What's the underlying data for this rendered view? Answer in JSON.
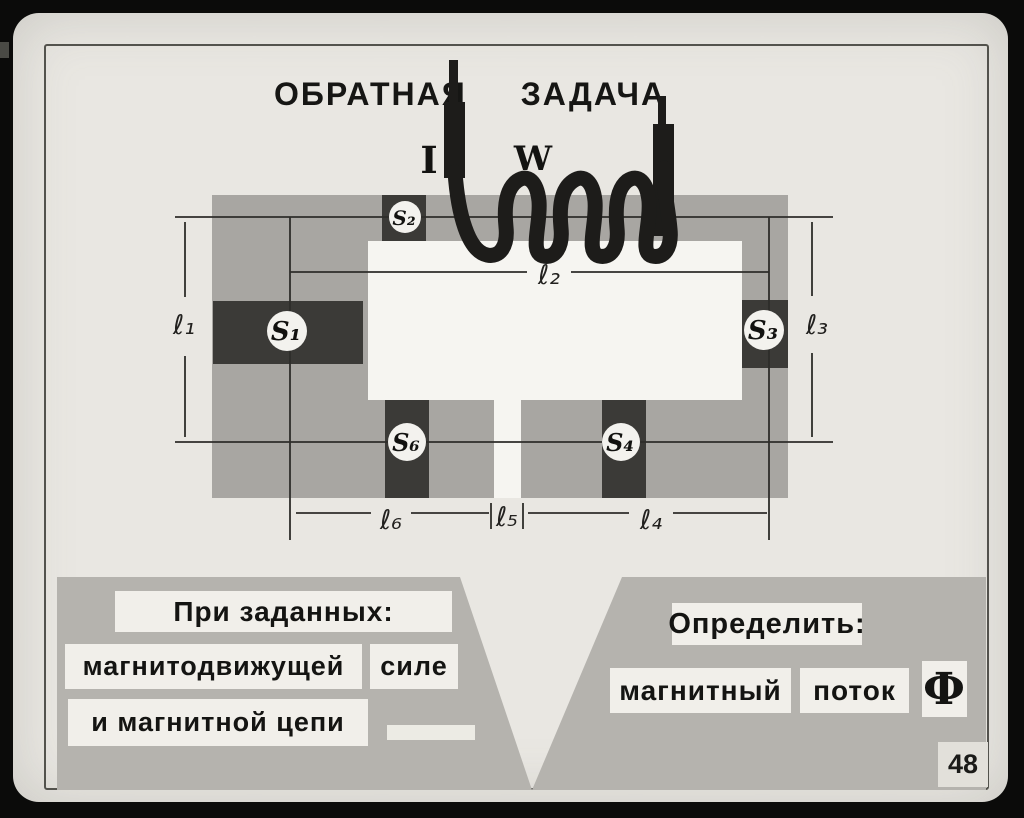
{
  "slide": {
    "title_word1": "ОБРАТНАЯ",
    "title_word2": "ЗАДАЧА",
    "page_number": "48"
  },
  "diagram": {
    "current_label": "I",
    "winding_label": "W",
    "sections": {
      "top": "S₂",
      "left": "S₁",
      "right": "S₃",
      "bottom_left": "S₆",
      "bottom_right": "S₄"
    },
    "lengths": {
      "left": "ℓ₁",
      "top": "ℓ₂",
      "right": "ℓ₃",
      "bottom_right": "ℓ₄",
      "gap": "ℓ₅",
      "bottom_left": "ℓ₆"
    }
  },
  "given_panel": {
    "line1": "При заданных:",
    "line2a": "магнитодвижущей",
    "line2b": "силе",
    "line3": "и магнитной цепи"
  },
  "find_panel": {
    "line1": "Определить:",
    "line2a": "магнитный",
    "line2b": "поток",
    "symbol": "Ф"
  },
  "colors": {
    "film_border": "#0b0b0a",
    "slide_background": "#e9e7e2",
    "core_gray": "#a8a6a2",
    "section_dark": "#3b3a37",
    "panel_gray": "#b5b3ae",
    "label_strip": "#f1efea",
    "ink": "#161614"
  }
}
